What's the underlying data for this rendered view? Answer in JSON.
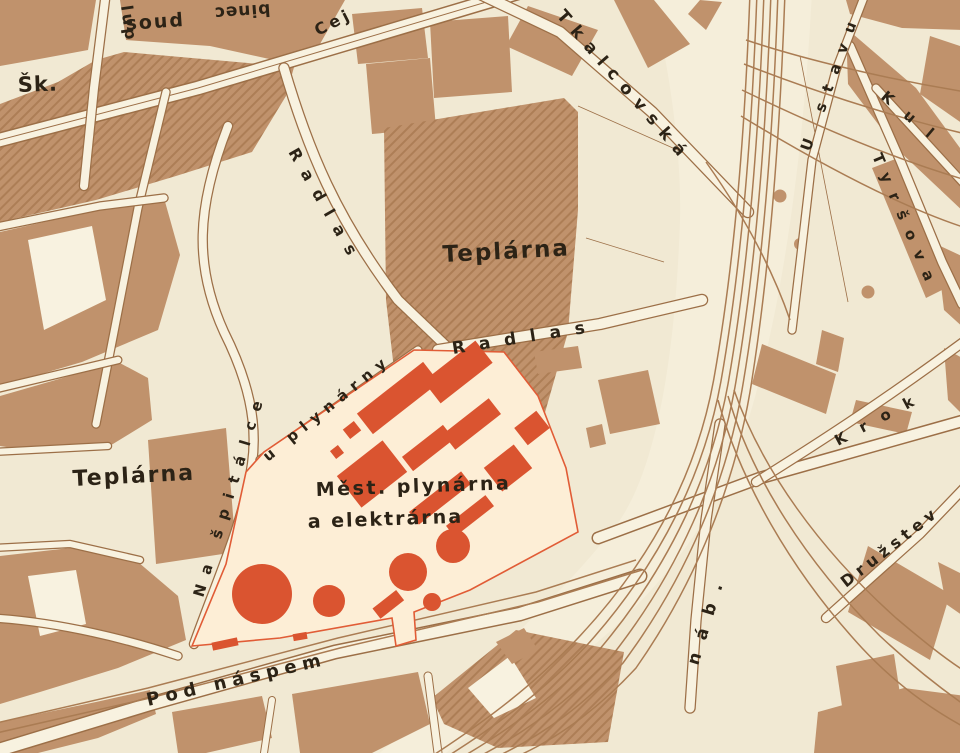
{
  "map": {
    "type": "historical-city-plan-scan",
    "palette": {
      "paper": "#f1e9d3",
      "street": "#f8f2e0",
      "block": "#c0926c",
      "block_dark": "#ad7e56",
      "edge": "#9c6f47",
      "rail": "#aa7c53",
      "hl_fill": "#fdeed6",
      "hl_red": "#da5430",
      "hl_border": "#e15c36",
      "ink": "#2c2316"
    },
    "labels": {
      "skola_abbrev": "Šk.",
      "street_fragment_lup": "lup",
      "soud": "soud",
      "binec": "binec",
      "street_cejl": "Cej",
      "street_tkalcovska": "Tkalcovská",
      "street_u_stavu": "U stavu",
      "street_kul_fragment": "Kul",
      "street_tyrsova": "Tyršova",
      "street_krok_fragment": "Krok",
      "street_druzstev_fragment": "Družstev",
      "street_nabrezi_abbrev": "náb.",
      "teplarna_center": "Teplárna",
      "teplarna_left": "Teplárna",
      "street_radlas_upper": "Radlas",
      "street_radlas_lower": "Radlas",
      "street_na_spitalce": "Na špitálce",
      "street_u_plynarny": "u plynárny",
      "plynarna_line1": "Měst. plynárna",
      "plynarna_line2": "a elektrárna",
      "street_pod_naspem": "Pod náspem"
    }
  }
}
